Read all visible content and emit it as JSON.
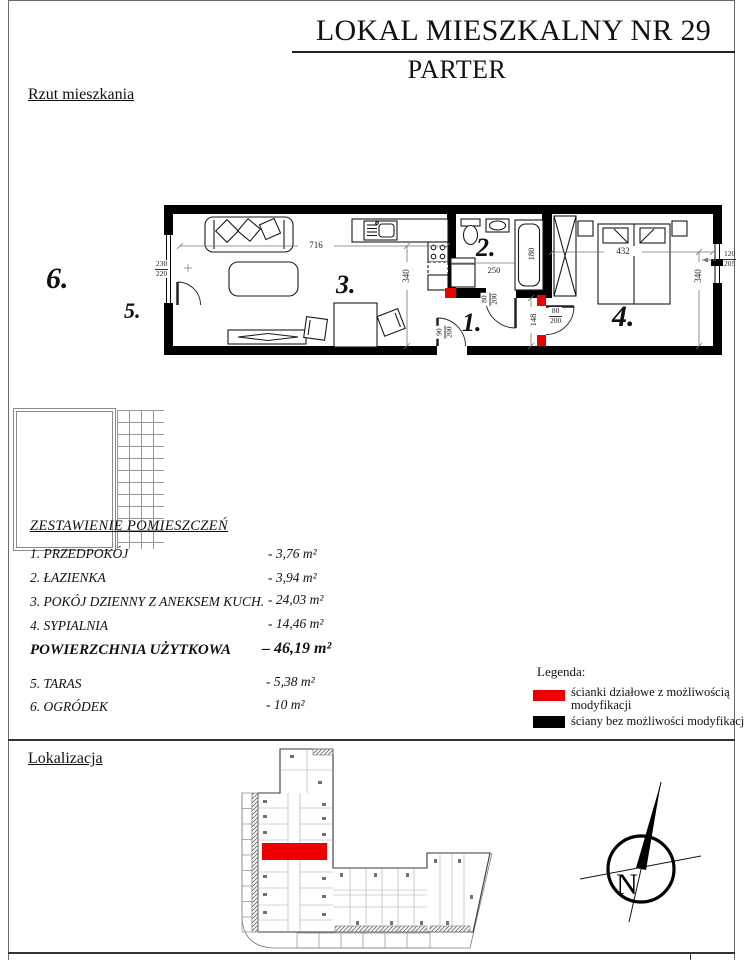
{
  "header": {
    "title": "LOKAL MIESZKALNY NR 29",
    "subtitle": "PARTER"
  },
  "sections": {
    "plan_label": "Rzut mieszkania",
    "location_label": "Lokalizacja"
  },
  "floor_plan": {
    "room_numbers": {
      "r1": "1.",
      "r2": "2.",
      "r3": "3.",
      "r4": "4.",
      "r5": "5.",
      "r6": "6."
    },
    "dimensions": {
      "living_width": "716",
      "living_depth": "340",
      "bath_width": "250",
      "tub_length": "180",
      "hall_depth": "148",
      "bedroom_width": "432",
      "bedroom_depth": "340",
      "balcony_door": {
        "w": "230",
        "h": "220"
      },
      "right_window": {
        "w": "120",
        "h": "205"
      },
      "bath_door": {
        "w": "80",
        "h": "200"
      },
      "bedroom_door": {
        "w": "80",
        "h": "200"
      },
      "entry_door": {
        "w": "90",
        "h": "200"
      }
    }
  },
  "room_schedule": {
    "title": "ZESTAWIENIE POMIESZCZEŃ",
    "rows": [
      {
        "label": "1. PRZEDPOKÓJ",
        "value": "- 3,76 m²"
      },
      {
        "label": "2. ŁAZIENKA",
        "value": "- 3,94 m²"
      },
      {
        "label": "3. POKÓJ DZIENNY Z ANEKSEM KUCH.",
        "value": "- 24,03 m²"
      },
      {
        "label": "4. SYPIALNIA",
        "value": "- 14,46 m²"
      }
    ],
    "total": {
      "label": "POWIERZCHNIA UŻYTKOWA",
      "value": "– 46,19 m²"
    },
    "extra_rows": [
      {
        "label": "5. TARAS",
        "value": "- 5,38 m²"
      },
      {
        "label": "6. OGRÓDEK",
        "value": "- 10 m²"
      }
    ]
  },
  "legend": {
    "title": "Legenda:",
    "items": [
      {
        "color": "#ee0000",
        "label": "ścianki działowe z możliwością modyfikacji"
      },
      {
        "color": "#000000",
        "label": "ściany bez możliwości modyfikacji"
      }
    ]
  },
  "compass": {
    "label": "N"
  },
  "colors": {
    "partition_red": "#ee0000",
    "wall_black": "#000000",
    "page_border": "#6b6b6b"
  }
}
